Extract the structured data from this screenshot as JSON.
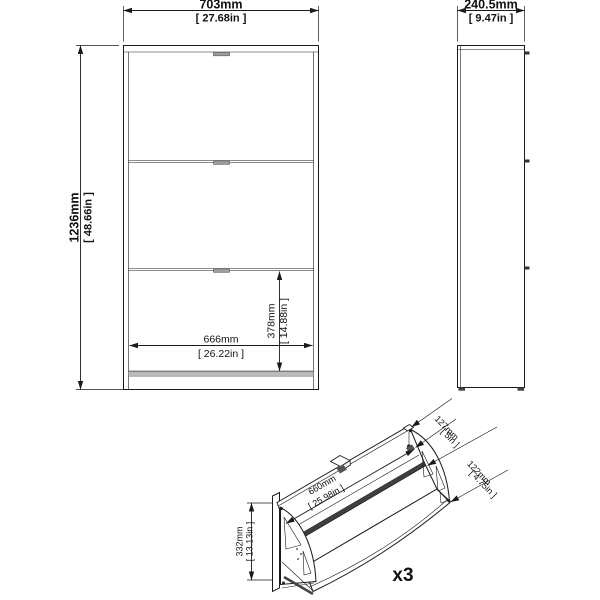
{
  "drawing_colors": {
    "line": "#1a1a1a",
    "dark_fill": "#3f3f3f",
    "gray_fill": "#bdbdbd",
    "background": "#ffffff"
  },
  "front_view": {
    "width_mm": "703mm",
    "width_in": "[ 27.68in ]",
    "height_mm": "1236mm",
    "height_in": "[ 48.66in ]",
    "inner_width_mm": "666mm",
    "inner_width_in": "[ 26.22in ]",
    "inner_height_mm": "378mm",
    "inner_height_in": "[ 14.88in ]"
  },
  "side_view": {
    "depth_mm": "240.5mm",
    "depth_in": "[ 9.47in ]"
  },
  "detail_view": {
    "flap_width_mm": "660mm",
    "flap_width_in": "[ 25.98in ]",
    "flap_height_mm": "332mm",
    "flap_height_in": "[ 13.13in ]",
    "top_opening_mm": "127mm",
    "top_opening_in": "[ 5in ]",
    "front_depth_mm": "122mm",
    "front_depth_in": "[ 4.75in ]",
    "quantity": "x3"
  }
}
